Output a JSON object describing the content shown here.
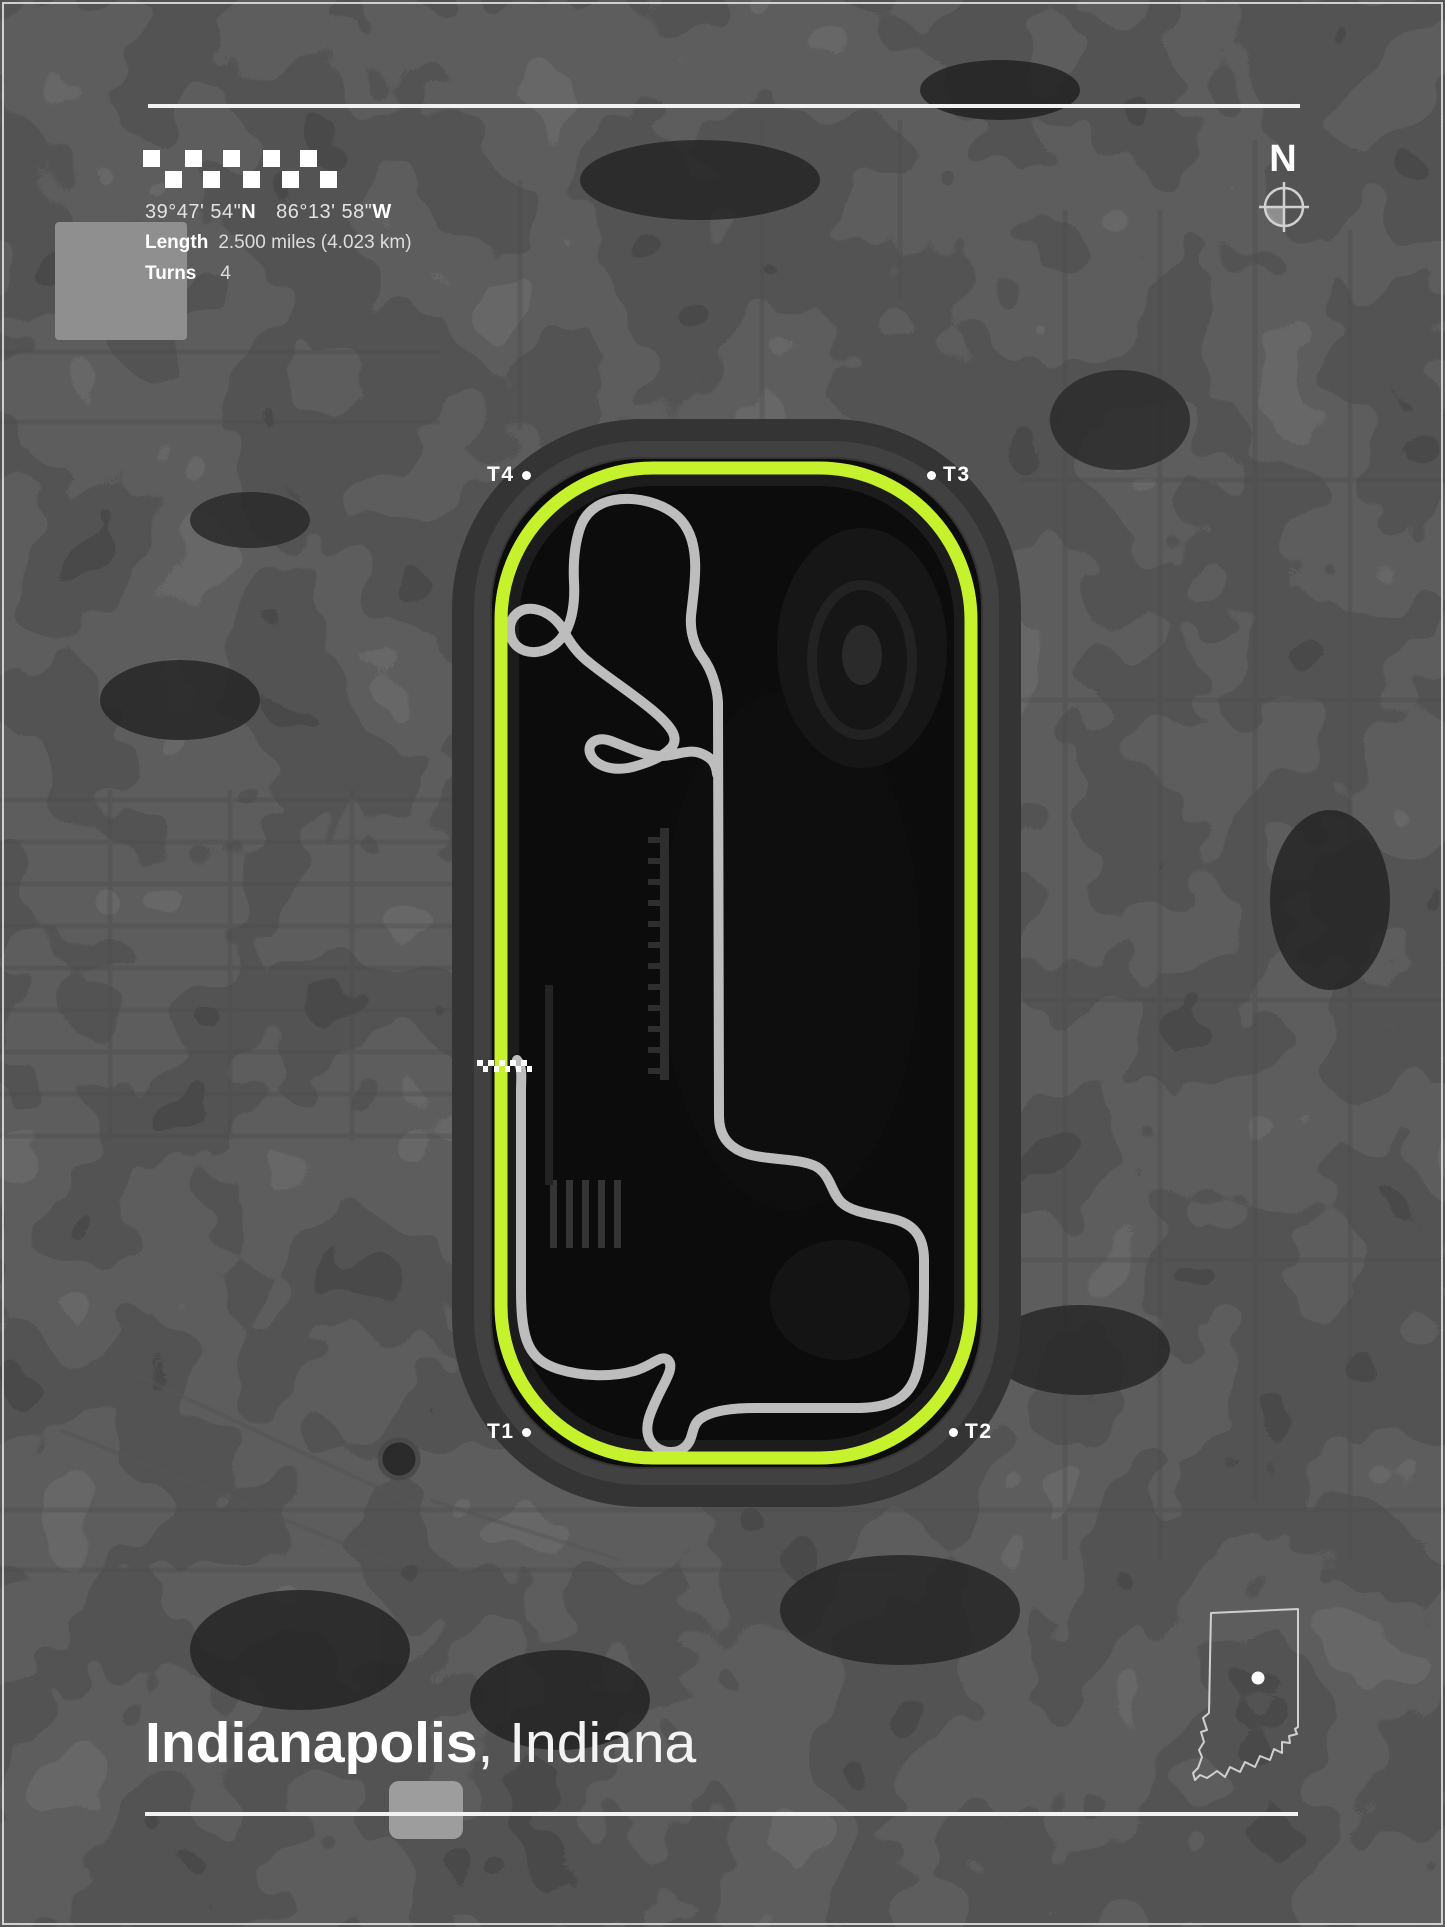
{
  "colors": {
    "track": "#c6f22d",
    "course": "#bdbdbd",
    "background": "#131313",
    "text": "#ffffff"
  },
  "header": {
    "coordinates": {
      "lat_value": "39°47' 54\"",
      "lat_hemisphere": "N",
      "lon_value": "86°13' 58\"",
      "lon_hemisphere": "W"
    },
    "length": {
      "label": "Length",
      "value": "2.500 miles (4.023 km)"
    },
    "turns": {
      "label": "Turns",
      "value": "4"
    }
  },
  "compass": {
    "north_label": "N"
  },
  "track_map": {
    "turn_markers": [
      {
        "id": "t4",
        "label": "T4",
        "dot_side": "right"
      },
      {
        "id": "t3",
        "label": "T3",
        "dot_side": "left"
      },
      {
        "id": "t1",
        "label": "T1",
        "dot_side": "right"
      },
      {
        "id": "t2",
        "label": "T2",
        "dot_side": "left"
      }
    ],
    "start_finish": "checkered-line"
  },
  "footer": {
    "title_city": "Indianapolis",
    "title_rest": ", Indiana",
    "state_inset": "Indiana"
  },
  "decor": {
    "header_flag": {
      "size": 17,
      "rows": [
        {
          "y": 0,
          "xs": [
            0,
            42,
            80,
            120,
            157
          ]
        },
        {
          "y": 21,
          "xs": [
            22,
            60,
            100,
            139,
            177
          ]
        }
      ]
    },
    "startfinish_flag": {
      "size": 5.5,
      "rows": [
        {
          "y": 0,
          "xs": [
            0,
            11,
            22,
            33,
            44
          ]
        },
        {
          "y": 6,
          "xs": [
            5.5,
            16.5,
            27.5,
            38.5,
            49.5
          ]
        }
      ]
    }
  }
}
